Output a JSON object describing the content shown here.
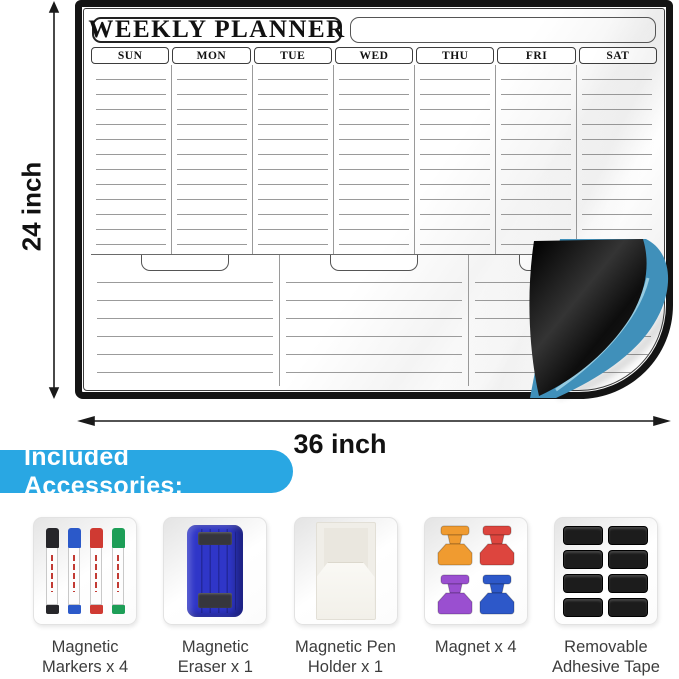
{
  "planner": {
    "title": "WEEKLY PLANNER",
    "days": [
      "SUN",
      "MON",
      "TUE",
      "WED",
      "THU",
      "FRI",
      "SAT"
    ]
  },
  "dimensions": {
    "height_label": "24 inch",
    "width_label": "36 inch"
  },
  "banner": {
    "label": "Included Accessories:"
  },
  "accessories": [
    {
      "name": "magnetic-markers",
      "line1": "Magnetic",
      "line2": "Markers x 4"
    },
    {
      "name": "magnetic-eraser",
      "line1": "Magnetic",
      "line2": "Eraser x 1"
    },
    {
      "name": "magnetic-pen-holder",
      "line1": "Magnetic Pen",
      "line2": "Holder x 1"
    },
    {
      "name": "magnets",
      "line1": "Magnet x 4",
      "line2": ""
    },
    {
      "name": "adhesive-tape",
      "line1": "Removable",
      "line2": "Adhesive Tape"
    }
  ],
  "colors": {
    "banner_blue": "#29a7e3",
    "curl_blue": "#4090ba",
    "curl_streak": "#a5d6e8",
    "backing_black": "#141414",
    "marker_black": "#26262a",
    "marker_blue": "#2b59c9",
    "marker_red": "#cf3a32",
    "marker_green": "#1d9e57",
    "eraser_blue": "#2f36c8",
    "magnet_orange": "#f09b30",
    "magnet_red": "#dd453e",
    "magnet_purple": "#9a4fd0",
    "magnet_blue": "#2d58c9",
    "tape_black": "#1c1c1c"
  }
}
